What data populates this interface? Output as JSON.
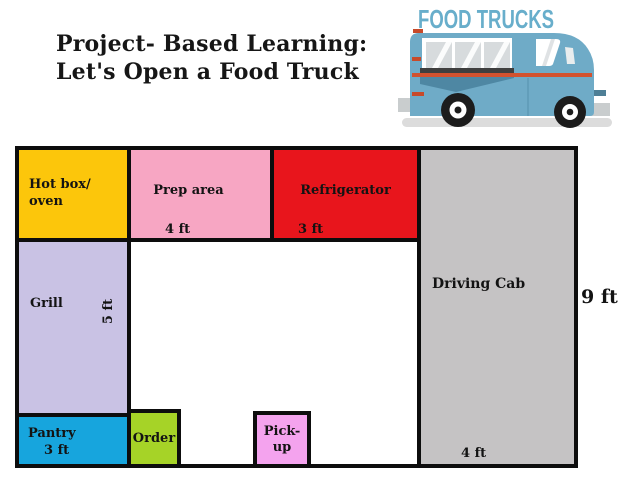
{
  "header": {
    "title_line1": "Project- Based Learning:",
    "title_line2": "Let's Open a Food Truck"
  },
  "logo": {
    "text": "FOOD TRUCKS"
  },
  "rooms": {
    "hotbox": {
      "label": "Hot box/\noven",
      "color": "#fcc60b"
    },
    "prep": {
      "label": "Prep area",
      "size": "4 ft",
      "color": "#f7a6c3"
    },
    "refrigerator": {
      "label": "Refrigerator",
      "size": "3 ft",
      "color": "#e8151c"
    },
    "driving_cab": {
      "label": "Driving Cab",
      "size": "4 ft",
      "color": "#c5c3c4"
    },
    "grill": {
      "label": "Grill",
      "size": "5 ft",
      "color": "#c9c2e4"
    },
    "pantry": {
      "label": "Pantry",
      "size": "3 ft",
      "color": "#17a5dd"
    },
    "order": {
      "label": "Order",
      "color": "#a6d327"
    },
    "pickup": {
      "label": "Pick-\nup",
      "color": "#f4a3ee"
    }
  },
  "dimensions": {
    "overall_height": "9 ft"
  },
  "colors": {
    "truck_body": "#6fabc7",
    "truck_body_shade": "#4e87a3",
    "truck_stripe": "#d2522f",
    "logo_text": "#68aecb",
    "outline": "#0d0d0d"
  }
}
